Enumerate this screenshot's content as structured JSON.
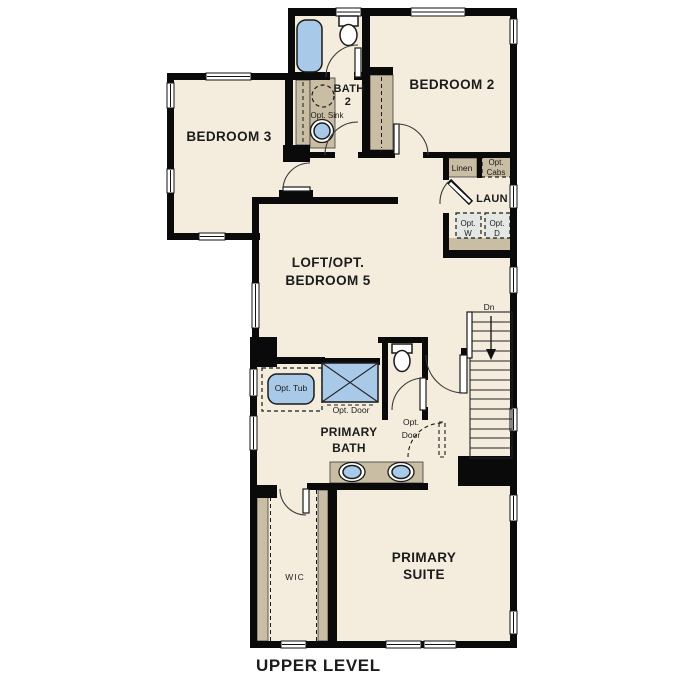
{
  "title": "UPPER LEVEL",
  "colors": {
    "floor": "#f4edde",
    "wall": "#0a0a0a",
    "wood": "#c9bda3",
    "blue": "#a8cae8",
    "appliance": "#e4e8e4"
  },
  "rooms": {
    "bedroom2": "BEDROOM 2",
    "bedroom3": "BEDROOM 3",
    "bath2": [
      "BATH",
      "2"
    ],
    "laundry": "LAUN",
    "loft": [
      "LOFT/OPT.",
      "BEDROOM 5"
    ],
    "primary_bath": [
      "PRIMARY",
      "BATH"
    ],
    "primary_suite": [
      "PRIMARY",
      "SUITE"
    ],
    "wic": "WIC"
  },
  "labels": {
    "opt_sink": "Opt. Sink",
    "linen": "Linen",
    "opt_cabs": [
      "Opt.",
      "Cabs"
    ],
    "opt_washer": [
      "Opt.",
      "W"
    ],
    "opt_dryer": [
      "Opt.",
      "D"
    ],
    "down": "Dn",
    "opt_tub": "Opt. Tub",
    "opt_door_shower": "Opt. Door",
    "opt_door_entry": [
      "Opt.",
      "Door"
    ]
  }
}
